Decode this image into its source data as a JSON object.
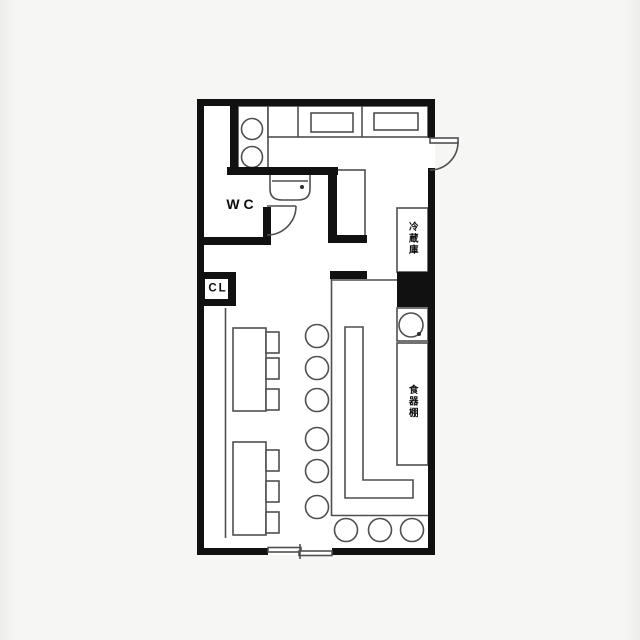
{
  "floorplan": {
    "labels": {
      "wc": "WC",
      "closet": "CL",
      "refrigerator": "冷蔵庫",
      "cupboard": "食器棚"
    },
    "colors": {
      "wall": "#111111",
      "line": "#4f4f4f",
      "floor": "#ffffff",
      "background": "#f6f6f4"
    }
  }
}
